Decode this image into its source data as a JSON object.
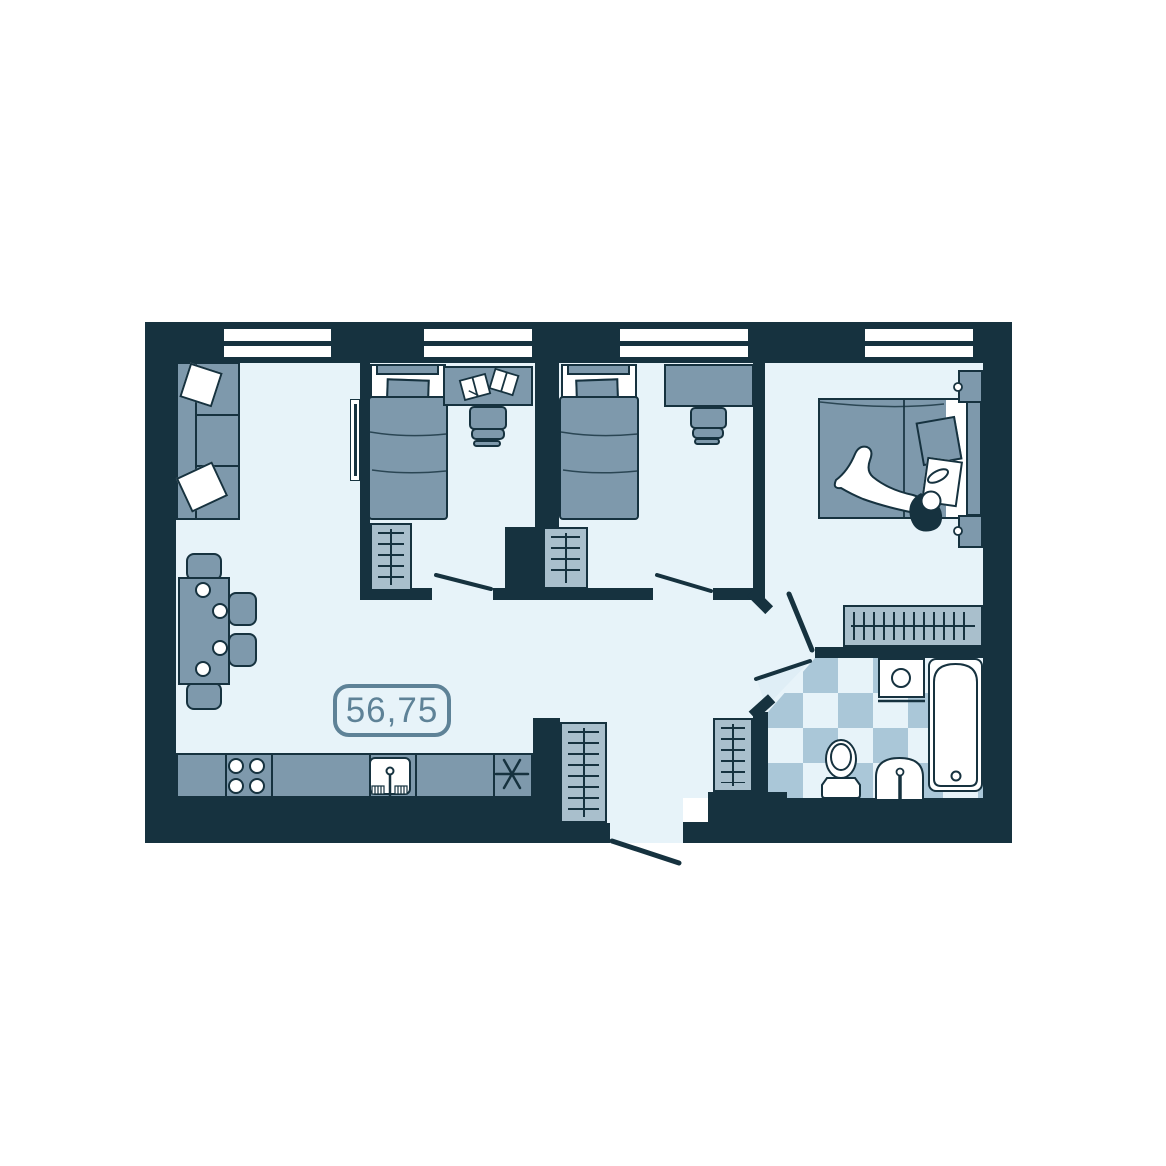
{
  "meta": {
    "type": "apartment-floor-plan"
  },
  "area_badge": {
    "value": "56,75"
  },
  "colors": {
    "paper": "#ffffff",
    "wall": "#16323f",
    "floor": "#e7f3f9",
    "furniture": "#7e99ac",
    "furniture_light": "#a9bfcc",
    "tile": "#aac7d8",
    "white": "#ffffff",
    "accent": "#5e8297",
    "door_shade": "#dfeef6"
  },
  "windows": {
    "count": 4
  },
  "doors": {
    "interior": 4,
    "entrance": 1
  },
  "rooms": [
    {
      "name": "living-room-kitchen",
      "furniture": [
        "sofa",
        "sofa-pillows",
        "wall-tv",
        "dining-table",
        "dining-chairs",
        "plates",
        "kitchen-counter",
        "stove-burners",
        "kitchen-sink",
        "fridge-symbol"
      ]
    },
    {
      "name": "bedroom-1",
      "furniture": [
        "single-bed",
        "pillow",
        "desk",
        "books",
        "chair",
        "wardrobe"
      ]
    },
    {
      "name": "bedroom-2",
      "furniture": [
        "single-bed",
        "pillow",
        "desk",
        "chair",
        "wardrobe"
      ]
    },
    {
      "name": "master-bedroom",
      "furniture": [
        "double-bed",
        "person",
        "pillows",
        "nightstand-top",
        "nightstand-bottom",
        "clothes-rail"
      ]
    },
    {
      "name": "bathroom",
      "floor": "checkerboard-tiles",
      "furniture": [
        "washing-machine",
        "bathtub",
        "toilet",
        "washbasin"
      ]
    },
    {
      "name": "hallway",
      "furniture": [
        "wardrobe-left",
        "wardrobe-right"
      ]
    }
  ]
}
